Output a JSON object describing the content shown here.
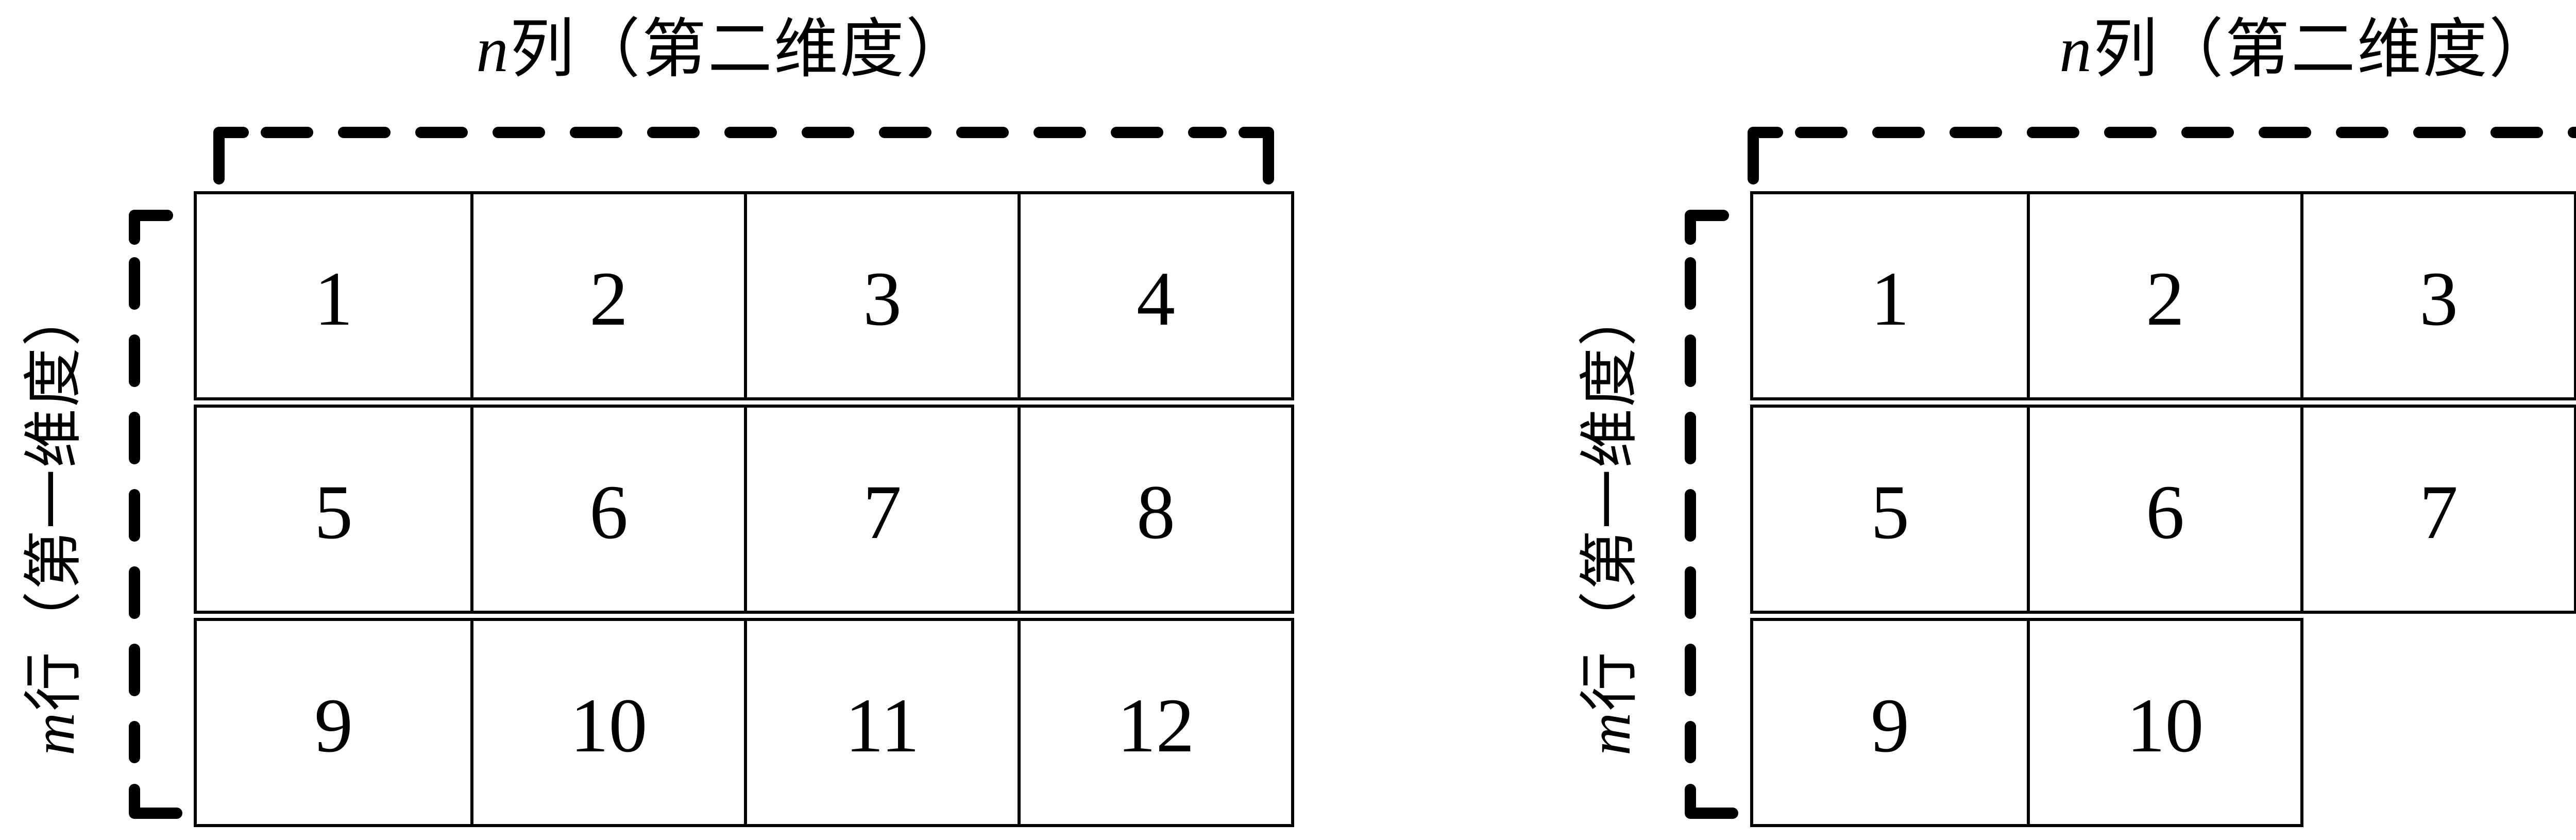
{
  "page": {
    "background": "#ffffff",
    "ink": "#000000"
  },
  "diagrams": [
    {
      "name": "rectangular-2d-array",
      "columns_label": {
        "variable": "n",
        "suffix": "列（第二维度）"
      },
      "rows_label": {
        "variable": "m",
        "suffix": "行（第一维度）"
      },
      "rows": [
        {
          "cells": [
            "1",
            "2",
            "3",
            "4"
          ]
        },
        {
          "cells": [
            "5",
            "6",
            "7",
            "8"
          ]
        },
        {
          "cells": [
            "9",
            "10",
            "11",
            "12"
          ]
        }
      ]
    },
    {
      "name": "jagged-2d-array",
      "columns_label": {
        "variable": "n",
        "suffix": "列（第二维度）"
      },
      "rows_label": {
        "variable": "m",
        "suffix": "行（第一维度）"
      },
      "rows": [
        {
          "cells": [
            "1",
            "2",
            "3"
          ]
        },
        {
          "cells": [
            "5",
            "6",
            "7",
            "8"
          ]
        },
        {
          "cells": [
            "9",
            "10"
          ]
        }
      ]
    }
  ]
}
